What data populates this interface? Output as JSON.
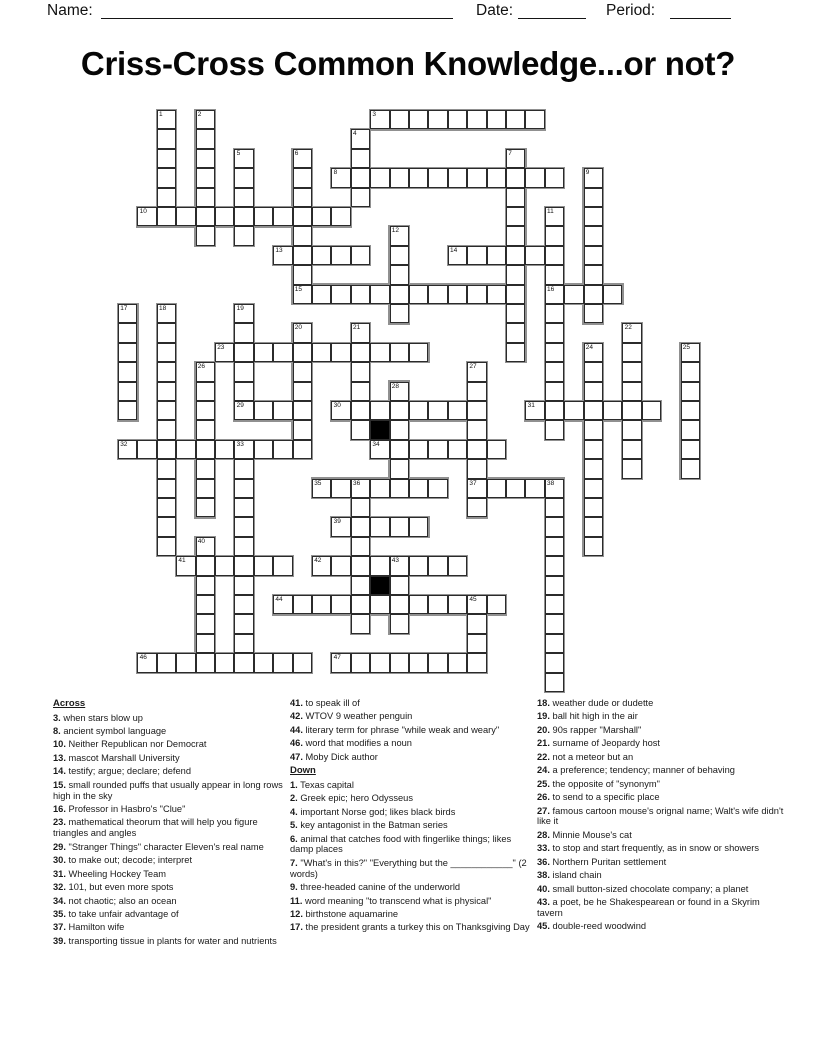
{
  "header": {
    "name_label": "Name:",
    "date_label": "Date:",
    "period_label": "Period:"
  },
  "title": "Criss-Cross Common Knowledge...or not?",
  "colors": {
    "grid_line": "#2b2b2b",
    "word_outline": "#909090",
    "block": "#000000",
    "text": "#1a1a1a"
  },
  "puzzle": {
    "origin_x": 118,
    "origin_y": 110,
    "cell_size": 19.4,
    "entries": [
      {
        "num": 1,
        "dir": "D",
        "col": 2,
        "row": 0,
        "len": 6
      },
      {
        "num": 2,
        "dir": "D",
        "col": 4,
        "row": 0,
        "len": 7
      },
      {
        "num": 3,
        "dir": "A",
        "col": 13,
        "row": 0,
        "len": 9
      },
      {
        "num": 4,
        "dir": "D",
        "col": 12,
        "row": 1,
        "len": 4
      },
      {
        "num": 5,
        "dir": "D",
        "col": 6,
        "row": 2,
        "len": 5
      },
      {
        "num": 6,
        "dir": "D",
        "col": 9,
        "row": 2,
        "len": 7
      },
      {
        "num": 7,
        "dir": "D",
        "col": 20,
        "row": 2,
        "len": 11
      },
      {
        "num": 8,
        "dir": "A",
        "col": 11,
        "row": 3,
        "len": 12
      },
      {
        "num": 9,
        "dir": "D",
        "col": 24,
        "row": 3,
        "len": 8
      },
      {
        "num": 10,
        "dir": "A",
        "col": 1,
        "row": 5,
        "len": 11
      },
      {
        "num": 11,
        "dir": "D",
        "col": 22,
        "row": 5,
        "len": 12
      },
      {
        "num": 12,
        "dir": "D",
        "col": 14,
        "row": 6,
        "len": 5
      },
      {
        "num": 13,
        "dir": "A",
        "col": 8,
        "row": 7,
        "len": 5
      },
      {
        "num": 14,
        "dir": "A",
        "col": 17,
        "row": 7,
        "len": 6
      },
      {
        "num": 15,
        "dir": "A",
        "col": 9,
        "row": 9,
        "len": 12
      },
      {
        "num": 16,
        "dir": "A",
        "col": 22,
        "row": 9,
        "len": 4
      },
      {
        "num": 17,
        "dir": "D",
        "col": 0,
        "row": 10,
        "len": 6
      },
      {
        "num": 18,
        "dir": "D",
        "col": 2,
        "row": 10,
        "len": 13
      },
      {
        "num": 19,
        "dir": "D",
        "col": 6,
        "row": 10,
        "len": 6
      },
      {
        "num": 20,
        "dir": "D",
        "col": 9,
        "row": 11,
        "len": 6
      },
      {
        "num": 21,
        "dir": "D",
        "col": 12,
        "row": 11,
        "len": 6
      },
      {
        "num": 22,
        "dir": "D",
        "col": 26,
        "row": 11,
        "len": 8
      },
      {
        "num": 23,
        "dir": "A",
        "col": 5,
        "row": 12,
        "len": 11
      },
      {
        "num": 24,
        "dir": "D",
        "col": 24,
        "row": 12,
        "len": 11
      },
      {
        "num": 25,
        "dir": "D",
        "col": 29,
        "row": 12,
        "len": 7
      },
      {
        "num": 26,
        "dir": "D",
        "col": 4,
        "row": 13,
        "len": 8
      },
      {
        "num": 27,
        "dir": "D",
        "col": 18,
        "row": 13,
        "len": 8
      },
      {
        "num": 28,
        "dir": "D",
        "col": 14,
        "row": 14,
        "len": 6
      },
      {
        "num": 29,
        "dir": "A",
        "col": 6,
        "row": 15,
        "len": 4
      },
      {
        "num": 30,
        "dir": "A",
        "col": 11,
        "row": 15,
        "len": 8
      },
      {
        "num": 31,
        "dir": "A",
        "col": 21,
        "row": 15,
        "len": 7
      },
      {
        "num": 32,
        "dir": "A",
        "col": 0,
        "row": 17,
        "len": 10
      },
      {
        "num": 33,
        "dir": "D",
        "col": 6,
        "row": 17,
        "len": 12
      },
      {
        "num": 34,
        "dir": "A",
        "col": 13,
        "row": 17,
        "len": 7
      },
      {
        "num": 35,
        "dir": "A",
        "col": 10,
        "row": 19,
        "len": 7
      },
      {
        "num": 36,
        "dir": "D",
        "col": 12,
        "row": 19,
        "len": 8
      },
      {
        "num": 37,
        "dir": "A",
        "col": 18,
        "row": 19,
        "len": 5
      },
      {
        "num": 38,
        "dir": "D",
        "col": 22,
        "row": 19,
        "len": 11
      },
      {
        "num": 39,
        "dir": "A",
        "col": 11,
        "row": 21,
        "len": 5
      },
      {
        "num": 40,
        "dir": "D",
        "col": 4,
        "row": 22,
        "len": 7
      },
      {
        "num": 41,
        "dir": "A",
        "col": 3,
        "row": 23,
        "len": 6
      },
      {
        "num": 42,
        "dir": "A",
        "col": 10,
        "row": 23,
        "len": 8
      },
      {
        "num": 43,
        "dir": "D",
        "col": 14,
        "row": 23,
        "len": 4
      },
      {
        "num": 44,
        "dir": "A",
        "col": 8,
        "row": 25,
        "len": 12
      },
      {
        "num": 45,
        "dir": "D",
        "col": 18,
        "row": 25,
        "len": 4
      },
      {
        "num": 46,
        "dir": "A",
        "col": 1,
        "row": 28,
        "len": 9
      },
      {
        "num": 47,
        "dir": "A",
        "col": 11,
        "row": 28,
        "len": 8
      }
    ],
    "black_cells": [
      [
        13,
        16
      ],
      [
        13,
        24
      ]
    ]
  },
  "clues": {
    "column1": [
      {
        "header": "Across"
      },
      {
        "n": "3",
        "t": "when stars blow up"
      },
      {
        "n": "8",
        "t": "ancient symbol language"
      },
      {
        "n": "10",
        "t": "Neither Republican nor Democrat"
      },
      {
        "n": "13",
        "t": "mascot Marshall University"
      },
      {
        "n": "14",
        "t": "testify; argue; declare; defend"
      },
      {
        "n": "15",
        "t": "small rounded puffs that usually appear in long rows high in the sky"
      },
      {
        "n": "16",
        "t": "Professor in Hasbro's \"Clue\""
      },
      {
        "n": "23",
        "t": "mathematical theorum that will help you figure triangles and angles"
      },
      {
        "n": "29",
        "t": "\"Stranger Things\" character Eleven's real name"
      },
      {
        "n": "30",
        "t": "to make out; decode; interpret"
      },
      {
        "n": "31",
        "t": "Wheeling Hockey Team"
      },
      {
        "n": "32",
        "t": "101, but even more spots"
      },
      {
        "n": "34",
        "t": "not chaotic; also an ocean"
      },
      {
        "n": "35",
        "t": "to take unfair advantage of"
      },
      {
        "n": "37",
        "t": "Hamilton wife"
      },
      {
        "n": "39",
        "t": "transporting tissue in plants for water and nutrients"
      }
    ],
    "column2": [
      {
        "n": "41",
        "t": "to speak ill of"
      },
      {
        "n": "42",
        "t": "WTOV 9 weather penguin"
      },
      {
        "n": "44",
        "t": "literary term for phrase \"while weak and weary\""
      },
      {
        "n": "46",
        "t": "word that modifies a noun"
      },
      {
        "n": "47",
        "t": "Moby Dick author"
      },
      {
        "header": "Down"
      },
      {
        "n": "1",
        "t": "Texas capital"
      },
      {
        "n": "2",
        "t": "Greek epic; hero Odysseus"
      },
      {
        "n": "4",
        "t": "important Norse god; likes black birds"
      },
      {
        "n": "5",
        "t": "key antagonist in the Batman series"
      },
      {
        "n": "6",
        "t": "animal that catches food with fingerlike things; likes damp places"
      },
      {
        "n": "7",
        "t": "\"What's in this?\" \"Everything but the ____________\" (2 words)"
      },
      {
        "n": "9",
        "t": "three-headed canine of the underworld"
      },
      {
        "n": "11",
        "t": "word meaning \"to transcend what is physical\""
      },
      {
        "n": "12",
        "t": "birthstone aquamarine"
      },
      {
        "n": "17",
        "t": "the president grants a turkey this on Thanksgiving Day"
      }
    ],
    "column3": [
      {
        "n": "18",
        "t": "weather dude or dudette"
      },
      {
        "n": "19",
        "t": "ball hit high in the air"
      },
      {
        "n": "20",
        "t": "90s rapper \"Marshall\""
      },
      {
        "n": "21",
        "t": "surname of Jeopardy host"
      },
      {
        "n": "22",
        "t": "not a meteor but an"
      },
      {
        "n": "24",
        "t": "a preference; tendency; manner of behaving"
      },
      {
        "n": "25",
        "t": "the opposite of \"synonym\""
      },
      {
        "n": "26",
        "t": "to send to a specific place"
      },
      {
        "n": "27",
        "t": "famous cartoon mouse's orignal name; Walt's wife didn't like it"
      },
      {
        "n": "28",
        "t": "Minnie Mouse's cat"
      },
      {
        "n": "33",
        "t": "to stop and start frequently, as in snow or showers"
      },
      {
        "n": "36",
        "t": "Northern Puritan settlement"
      },
      {
        "n": "38",
        "t": "island chain"
      },
      {
        "n": "40",
        "t": "small button-sized chocolate company; a planet"
      },
      {
        "n": "43",
        "t": "a poet, be he Shakespearean or found in a Skyrim tavern"
      },
      {
        "n": "45",
        "t": "double-reed woodwind"
      }
    ]
  }
}
